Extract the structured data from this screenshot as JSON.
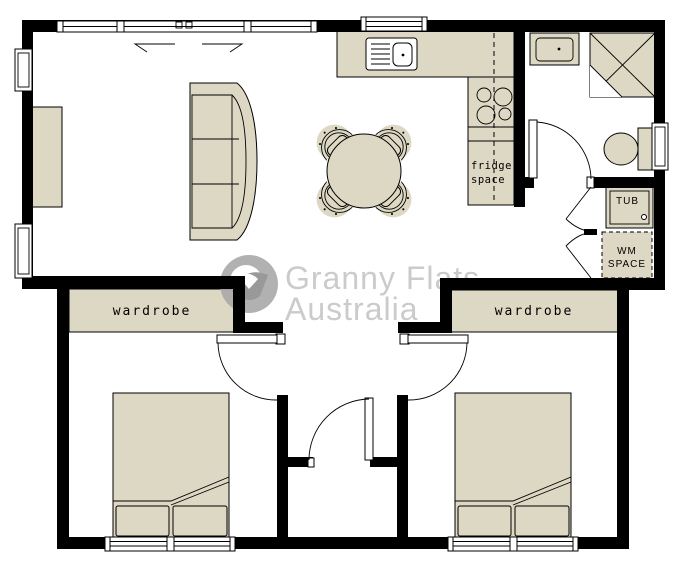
{
  "watermark": {
    "line1": "Granny Flats",
    "line2": "Australia"
  },
  "labels": {
    "wardrobe_left": "wardrobe",
    "wardrobe_right": "wardrobe",
    "fridge_line1": "fridge",
    "fridge_line2": "space",
    "tub": "TUB",
    "wm_line1": "WM",
    "wm_line2": "SPACE"
  },
  "colors": {
    "furniture": "#ddd8c3",
    "wall": "#000000",
    "watermark-text": "#c6c6c6",
    "watermark-logo": "#a9a9a9",
    "watermark-logo-dark": "#8f8f8f"
  }
}
